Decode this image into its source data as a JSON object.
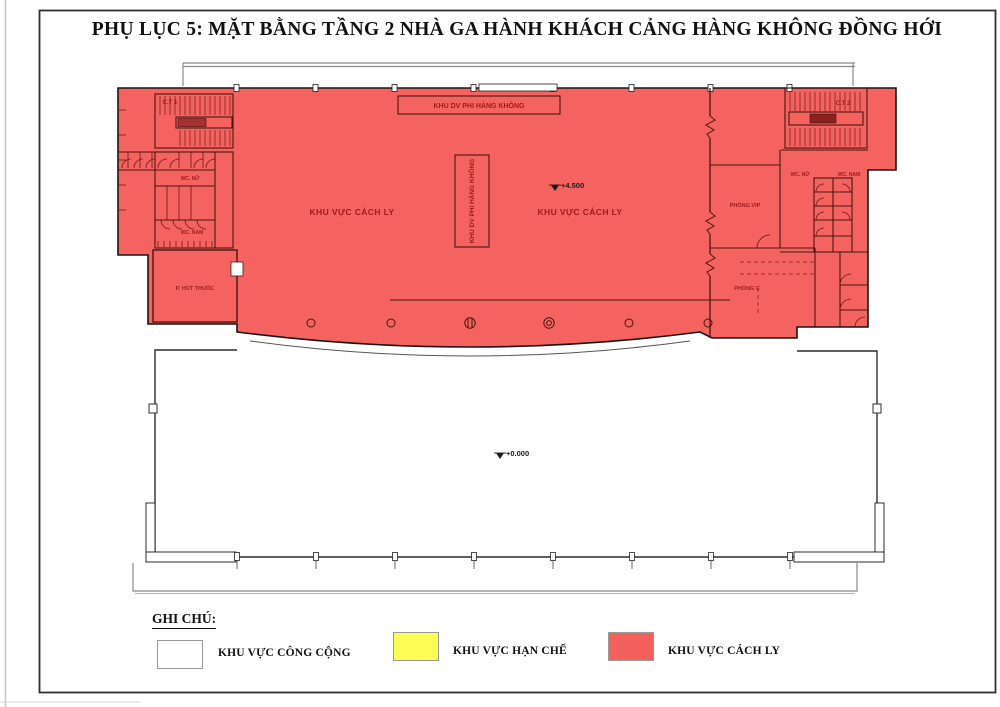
{
  "title": "PHỤ LỤC 5: MẶT BẰNG TẦNG 2 NHÀ GA HÀNH KHÁCH CẢNG HÀNG KHÔNG ĐỒNG HỚI",
  "plan": {
    "stairs": {
      "left": "C.T 1",
      "right": "C.T 2"
    },
    "non_aviation_service": "KHU DV PHI HÀNG KHÔNG",
    "isolation_area": "KHU VỰC CÁCH LY",
    "wc_female": "WC. NỮ",
    "wc_male": "WC. NAM",
    "smoking_room": "P. HÚT THUỐC",
    "vip_room": "PHÒNG VIP",
    "room_c": "PHÒNG C",
    "levels": {
      "upper": "+4.500",
      "ground": "+0.000"
    }
  },
  "legend": {
    "heading": "GHI CHÚ:",
    "items": [
      {
        "label": "KHU VỰC CÔNG CỘNG",
        "color": "#ffffff"
      },
      {
        "label": "KHU VỰC HẠN CHẾ",
        "color": "#fdfd55"
      },
      {
        "label": "KHU VỰC CÁCH LY",
        "color": "#f4615c"
      }
    ]
  },
  "colors": {
    "isolation_fill": "#f4635f",
    "outline": "#161616",
    "inner_wall": "#4a1412",
    "label": "#9e1b1b"
  }
}
